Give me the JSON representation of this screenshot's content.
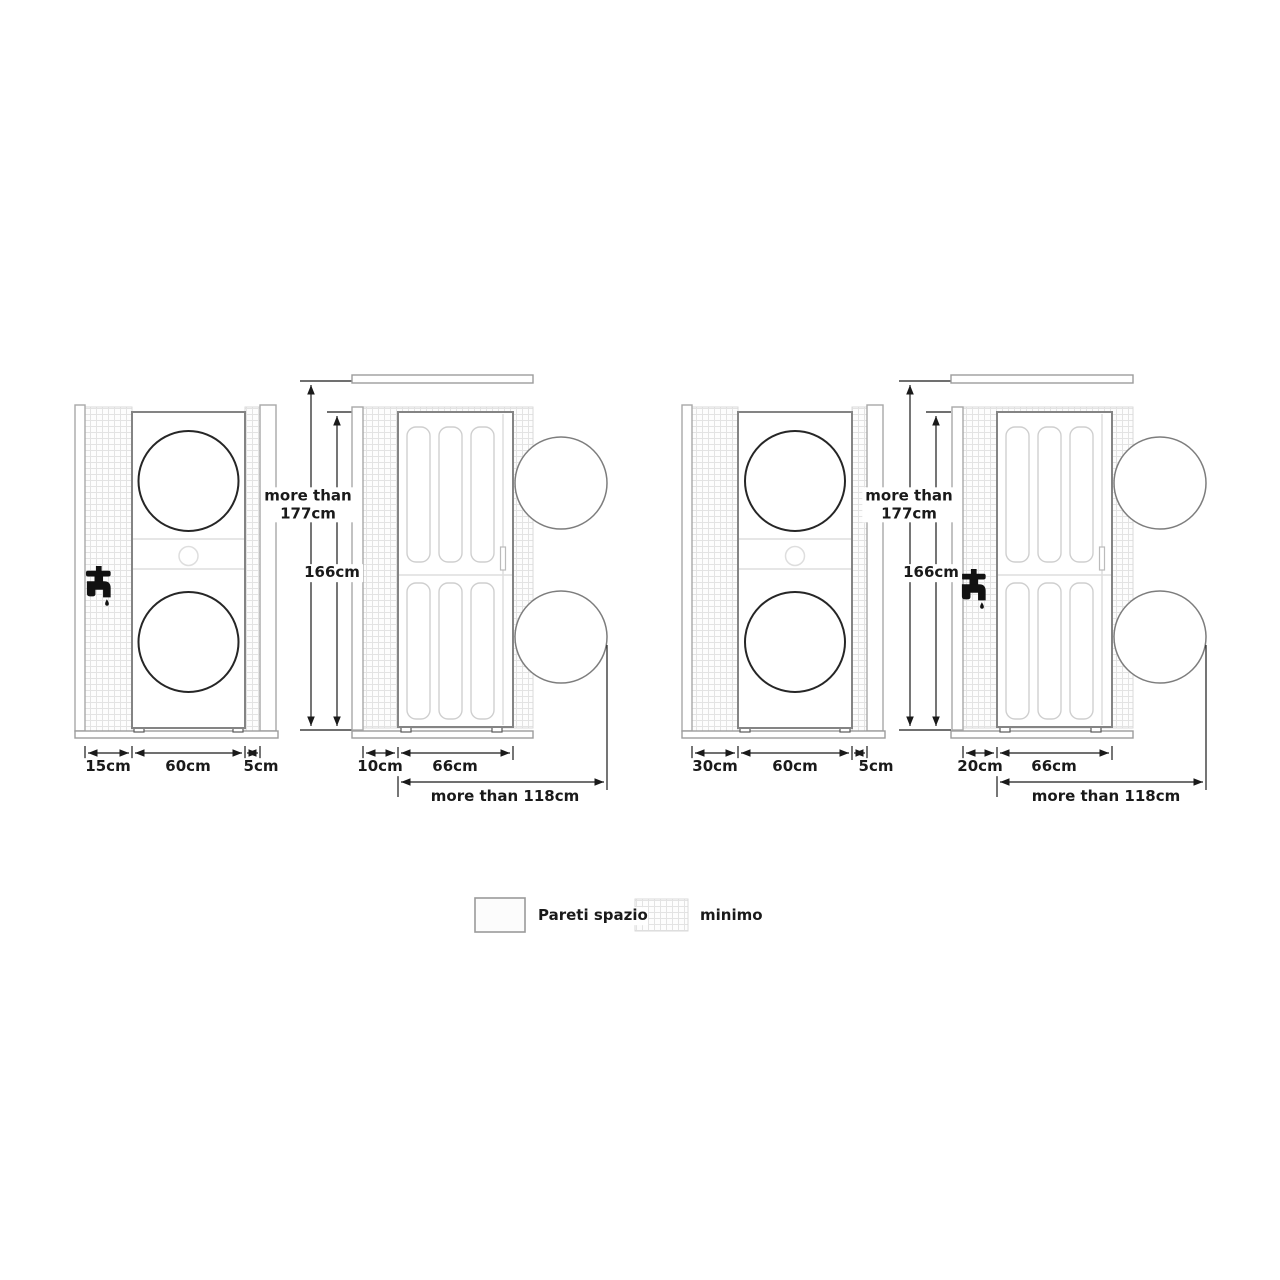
{
  "icons": [
    "faucet-icon"
  ],
  "colors": {
    "background": "#ffffff",
    "unit_outline": "#848484",
    "drum_outline": "#262626",
    "dimension_line": "#1a1a1a",
    "wall_outline": "#a8a8a8",
    "grid_line": "#e3e3e3",
    "swing_circle": "#7d7d7d",
    "text": "#1a1a1a"
  },
  "diagram_left": {
    "front": {
      "dim_left": "15cm",
      "dim_width": "60cm",
      "dim_right": "5cm"
    },
    "heights": {
      "ceiling": "more than\n177cm",
      "unit": "166cm"
    },
    "side": {
      "dim_back": "10cm",
      "dim_depth": "66cm",
      "dim_clearance": "more than 118cm"
    }
  },
  "diagram_right": {
    "front": {
      "dim_left": "30cm",
      "dim_width": "60cm",
      "dim_right": "5cm"
    },
    "heights": {
      "ceiling": "more than\n177cm",
      "unit": "166cm"
    },
    "side": {
      "dim_back": "20cm",
      "dim_depth": "66cm",
      "dim_clearance": "more than 118cm"
    }
  },
  "legend": {
    "wall_label": "Pareti spazio",
    "minimum_label": "minimo"
  }
}
